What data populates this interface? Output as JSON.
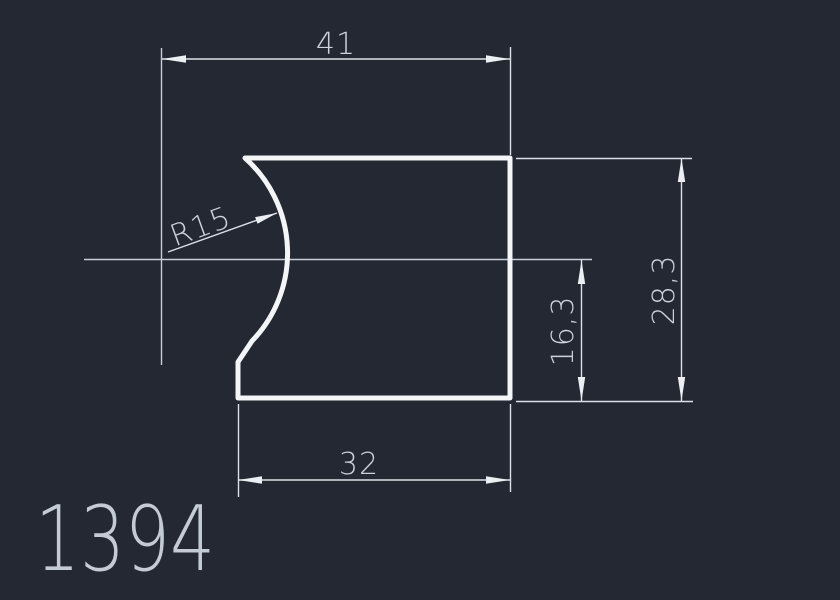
{
  "canvas": {
    "background_color": "#232833",
    "outline_color": "#f4f5f7",
    "thin_line_color": "#dde1e7",
    "text_color": "#ccd1da"
  },
  "drawing": {
    "part_number": "1394",
    "dimensions": {
      "top_width": "41",
      "bottom_width": "32",
      "right_height": "28,3",
      "inner_height": "16,3",
      "radius": "R15"
    }
  }
}
